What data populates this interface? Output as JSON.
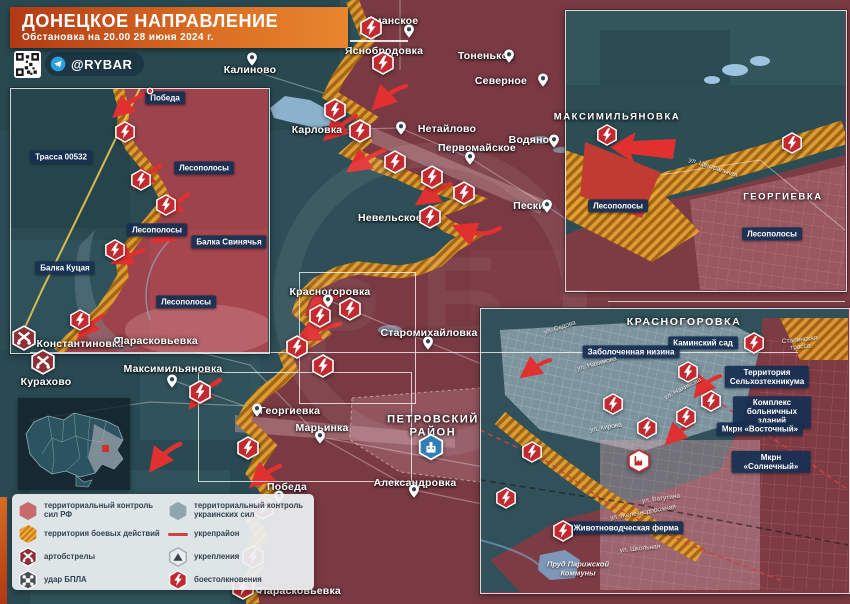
{
  "header": {
    "title": "ДОНЕЦКОЕ НАПРАВЛЕНИЕ",
    "subtitle": "Обстановка на 20.00 28 июня 2024 г.",
    "brand": "@RYBAR"
  },
  "colors": {
    "rf_control": "#9c434b",
    "ua_control": "#2e4f58",
    "battle_zone": "#e2a233",
    "fortified_line": "#d04040",
    "label_box": "#162f53",
    "banner_orange": "#d96b22",
    "clash_red": "#c22a30"
  },
  "legend": {
    "columns": [
      [
        {
          "ic": "rf",
          "label": "территориальный контроль сил РФ"
        },
        {
          "ic": "battle",
          "label": "территория боевых действий"
        },
        {
          "ic": "art",
          "label": "артобстрелы"
        },
        {
          "ic": "drone",
          "label": "удар БПЛА"
        }
      ],
      [
        {
          "ic": "ua",
          "label": "территориальный контроль украинских сил"
        },
        {
          "ic": "line",
          "label": "укрепрайон"
        },
        {
          "ic": "fort",
          "label": "укрепления"
        },
        {
          "ic": "clash",
          "label": "боестолкновения"
        }
      ]
    ]
  },
  "map": {
    "labels": [
      {
        "t": "Калиново",
        "x": 250,
        "y": 70,
        "tp": "plain"
      },
      {
        "t": "Уманское",
        "x": 393,
        "y": 21,
        "tp": "plain"
      },
      {
        "t": "Яснобродовка",
        "x": 384,
        "y": 51,
        "tp": "plain"
      },
      {
        "t": "Тоненькое",
        "x": 486,
        "y": 56,
        "tp": "plain"
      },
      {
        "t": "Северное",
        "x": 501,
        "y": 81,
        "tp": "plain"
      },
      {
        "t": "Карловка",
        "x": 317,
        "y": 130,
        "tp": "plain"
      },
      {
        "t": "Нетайлово",
        "x": 447,
        "y": 129,
        "tp": "plain"
      },
      {
        "t": "Первомайское",
        "x": 477,
        "y": 148,
        "tp": "plain"
      },
      {
        "t": "Водяное",
        "x": 532,
        "y": 140,
        "tp": "plain"
      },
      {
        "t": "Пески",
        "x": 529,
        "y": 206,
        "tp": "plain"
      },
      {
        "t": "Невельское",
        "x": 390,
        "y": 218,
        "tp": "plain"
      },
      {
        "t": "Красногоровка",
        "x": 330,
        "y": 292,
        "tp": "plain"
      },
      {
        "t": "Старомихайловка",
        "x": 429,
        "y": 333,
        "tp": "plain"
      },
      {
        "t": "Константиновка",
        "x": 80,
        "y": 344,
        "tp": "plain"
      },
      {
        "t": "Парасковьевка",
        "x": 157,
        "y": 341,
        "tp": "plain"
      },
      {
        "t": "Курахово",
        "x": 46,
        "y": 382,
        "tp": "plain"
      },
      {
        "t": "Максимильяновка",
        "x": 173,
        "y": 369,
        "tp": "plain"
      },
      {
        "t": "Георгиевка",
        "x": 290,
        "y": 411,
        "tp": "plain"
      },
      {
        "t": "Марьинка",
        "x": 322,
        "y": 428,
        "tp": "plain"
      },
      {
        "t": "ПЕТРОВСКИЙ\nРАЙОН",
        "x": 433,
        "y": 426,
        "tp": "caps"
      },
      {
        "t": "Александровка",
        "x": 415,
        "y": 483,
        "tp": "plain"
      },
      {
        "t": "Победа",
        "x": 287,
        "y": 487,
        "tp": "plain"
      },
      {
        "t": "Парасковьевка",
        "x": 300,
        "y": 591,
        "tp": "plain"
      },
      {
        "t": "Победа",
        "x": 165,
        "y": 98,
        "tp": "box"
      },
      {
        "t": "Трасса 00532",
        "x": 61,
        "y": 157,
        "tp": "box"
      },
      {
        "t": "Лесополосы",
        "x": 204,
        "y": 168,
        "tp": "box"
      },
      {
        "t": "Лесополосы",
        "x": 157,
        "y": 230,
        "tp": "box"
      },
      {
        "t": "Балка Свинячья",
        "x": 229,
        "y": 242,
        "tp": "box"
      },
      {
        "t": "Балка Куцая",
        "x": 65,
        "y": 268,
        "tp": "box"
      },
      {
        "t": "Лесополосы",
        "x": 186,
        "y": 302,
        "tp": "box"
      },
      {
        "t": "МАКСИМИЛЬЯНОВКА",
        "x": 617,
        "y": 118,
        "tp": "caps",
        "fs": 9.5
      },
      {
        "t": "ГЕОРГИЕВКА",
        "x": 783,
        "y": 198,
        "tp": "caps",
        "fs": 9.5
      },
      {
        "t": "Лесополосы",
        "x": 618,
        "y": 206,
        "tp": "box"
      },
      {
        "t": "Лесополосы",
        "x": 772,
        "y": 234,
        "tp": "box"
      },
      {
        "t": "ул. Центральная",
        "x": 713,
        "y": 168,
        "tp": "street",
        "rot": 18
      },
      {
        "t": "КРАСНОГОРОВКА",
        "x": 684,
        "y": 322,
        "tp": "caps",
        "fs": 10.5
      },
      {
        "t": "Каминский сад",
        "x": 703,
        "y": 343,
        "tp": "box"
      },
      {
        "t": "Заболоченная низина",
        "x": 631,
        "y": 352,
        "tp": "box"
      },
      {
        "t": "Территория\nСельхозтехникума",
        "x": 767,
        "y": 377,
        "tp": "box"
      },
      {
        "t": "Комплекс\nбольничных зданий",
        "x": 772,
        "y": 412,
        "tp": "box"
      },
      {
        "t": "Мкрн «Восточный»",
        "x": 760,
        "y": 429,
        "tp": "box"
      },
      {
        "t": "Мкрн «Солнечный»",
        "x": 771,
        "y": 462,
        "tp": "box"
      },
      {
        "t": "Животноводческая ферма",
        "x": 626,
        "y": 528,
        "tp": "box"
      },
      {
        "t": "Пруд Парижской\nКоммуны",
        "x": 578,
        "y": 569,
        "tp": "italic"
      },
      {
        "t": "ул. Седова",
        "x": 560,
        "y": 328,
        "tp": "street",
        "rot": -18
      },
      {
        "t": "ул. Нахимова",
        "x": 597,
        "y": 364,
        "tp": "street",
        "rot": -15
      },
      {
        "t": "ул. Нахимова",
        "x": 683,
        "y": 389,
        "tp": "street",
        "rot": -28
      },
      {
        "t": "ул. Кирова",
        "x": 606,
        "y": 428,
        "tp": "street",
        "rot": -10
      },
      {
        "t": "ул. Ватутина",
        "x": 661,
        "y": 499,
        "tp": "street",
        "rot": -8
      },
      {
        "t": "ул. Железнодорожная",
        "x": 643,
        "y": 513,
        "tp": "street",
        "rot": -10
      },
      {
        "t": "ул. Школьная",
        "x": 640,
        "y": 549,
        "tp": "street",
        "rot": -6
      },
      {
        "t": "Сталинская трасса",
        "x": 800,
        "y": 344,
        "tp": "street",
        "rot": -6
      }
    ],
    "markers": [
      {
        "k": "clash",
        "x": 371,
        "y": 28
      },
      {
        "k": "clash",
        "x": 383,
        "y": 63
      },
      {
        "k": "clash",
        "x": 335,
        "y": 110
      },
      {
        "k": "clash",
        "x": 360,
        "y": 131
      },
      {
        "k": "clash",
        "x": 395,
        "y": 162
      },
      {
        "k": "clash",
        "x": 432,
        "y": 177
      },
      {
        "k": "clash",
        "x": 464,
        "y": 193
      },
      {
        "k": "clash",
        "x": 430,
        "y": 217
      },
      {
        "k": "clash",
        "x": 350,
        "y": 309
      },
      {
        "k": "clash",
        "x": 320,
        "y": 316
      },
      {
        "k": "clash",
        "x": 297,
        "y": 347
      },
      {
        "k": "clash",
        "x": 323,
        "y": 366
      },
      {
        "k": "clash",
        "x": 200,
        "y": 392
      },
      {
        "k": "clash",
        "x": 248,
        "y": 448
      },
      {
        "k": "clash",
        "x": 263,
        "y": 508
      },
      {
        "k": "clash",
        "x": 253,
        "y": 557
      },
      {
        "k": "clash",
        "x": 243,
        "y": 588
      },
      {
        "k": "clash",
        "x": 125,
        "y": 132,
        "s": 22
      },
      {
        "k": "clash",
        "x": 141,
        "y": 180,
        "s": 22
      },
      {
        "k": "clash",
        "x": 166,
        "y": 205,
        "s": 22
      },
      {
        "k": "clash",
        "x": 115,
        "y": 250,
        "s": 22
      },
      {
        "k": "clash",
        "x": 80,
        "y": 320,
        "s": 22
      },
      {
        "k": "clash",
        "x": 607,
        "y": 135,
        "s": 22
      },
      {
        "k": "clash",
        "x": 792,
        "y": 143,
        "s": 22
      },
      {
        "k": "clash",
        "x": 754,
        "y": 343,
        "s": 22
      },
      {
        "k": "clash",
        "x": 688,
        "y": 372,
        "s": 22
      },
      {
        "k": "clash",
        "x": 711,
        "y": 401,
        "s": 22
      },
      {
        "k": "clash",
        "x": 686,
        "y": 417,
        "s": 22
      },
      {
        "k": "clash",
        "x": 647,
        "y": 428,
        "s": 22
      },
      {
        "k": "clash",
        "x": 613,
        "y": 404,
        "s": 22
      },
      {
        "k": "clash",
        "x": 532,
        "y": 452,
        "s": 22
      },
      {
        "k": "clash",
        "x": 506,
        "y": 498,
        "s": 22
      },
      {
        "k": "clash",
        "x": 563,
        "y": 531,
        "s": 22
      },
      {
        "k": "art",
        "x": 24,
        "y": 338,
        "s": 26
      },
      {
        "k": "art",
        "x": 43,
        "y": 362,
        "s": 26
      },
      {
        "k": "factory",
        "x": 639,
        "y": 461,
        "s": 24
      },
      {
        "k": "district",
        "x": 431,
        "y": 447,
        "s": 27
      },
      {
        "k": "pin",
        "x": 252,
        "y": 59
      },
      {
        "k": "pin",
        "x": 409,
        "y": 31
      },
      {
        "k": "pin",
        "x": 509,
        "y": 56
      },
      {
        "k": "pin",
        "x": 543,
        "y": 80
      },
      {
        "k": "pin",
        "x": 401,
        "y": 128
      },
      {
        "k": "pin",
        "x": 470,
        "y": 158
      },
      {
        "k": "pin",
        "x": 554,
        "y": 141
      },
      {
        "k": "pin",
        "x": 547,
        "y": 206
      },
      {
        "k": "pin",
        "x": 328,
        "y": 301
      },
      {
        "k": "pin",
        "x": 428,
        "y": 343
      },
      {
        "k": "pin",
        "x": 172,
        "y": 381
      },
      {
        "k": "pin",
        "x": 257,
        "y": 410
      },
      {
        "k": "pin",
        "x": 320,
        "y": 437
      },
      {
        "k": "pin",
        "x": 414,
        "y": 491
      },
      {
        "k": "pin",
        "x": 279,
        "y": 497
      },
      {
        "k": "dot",
        "x": 117,
        "y": 340
      },
      {
        "k": "dot",
        "x": 259,
        "y": 590
      },
      {
        "k": "reddot",
        "x": 150,
        "y": 91
      }
    ]
  }
}
